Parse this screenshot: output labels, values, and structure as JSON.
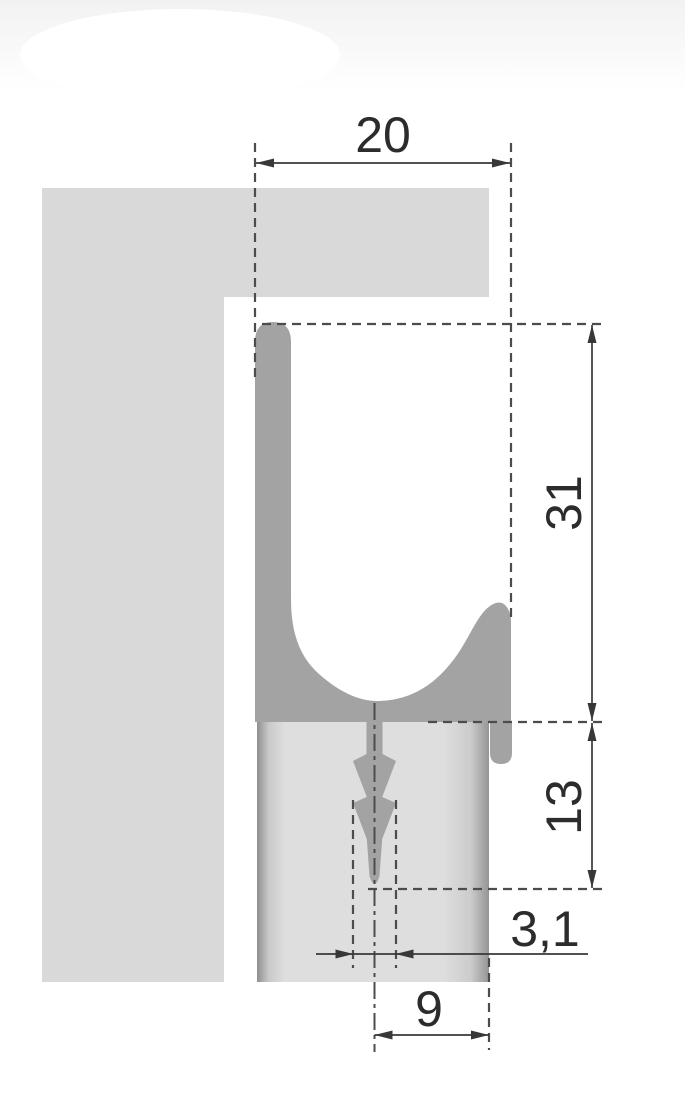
{
  "drawing": {
    "dims": {
      "top_width": "20",
      "upper_height": "31",
      "lower_height": "13",
      "slot_width": "3,1",
      "bottom_offset": "9"
    },
    "colors": {
      "profile": "#a3a3a3",
      "cabinet_panel": "#d9d9d9",
      "door_panel": "#dedede",
      "door_panel_edge": "#8e8e8e",
      "dimension_lines": "#383838",
      "dimension_text": "#2c2c2c"
    }
  }
}
